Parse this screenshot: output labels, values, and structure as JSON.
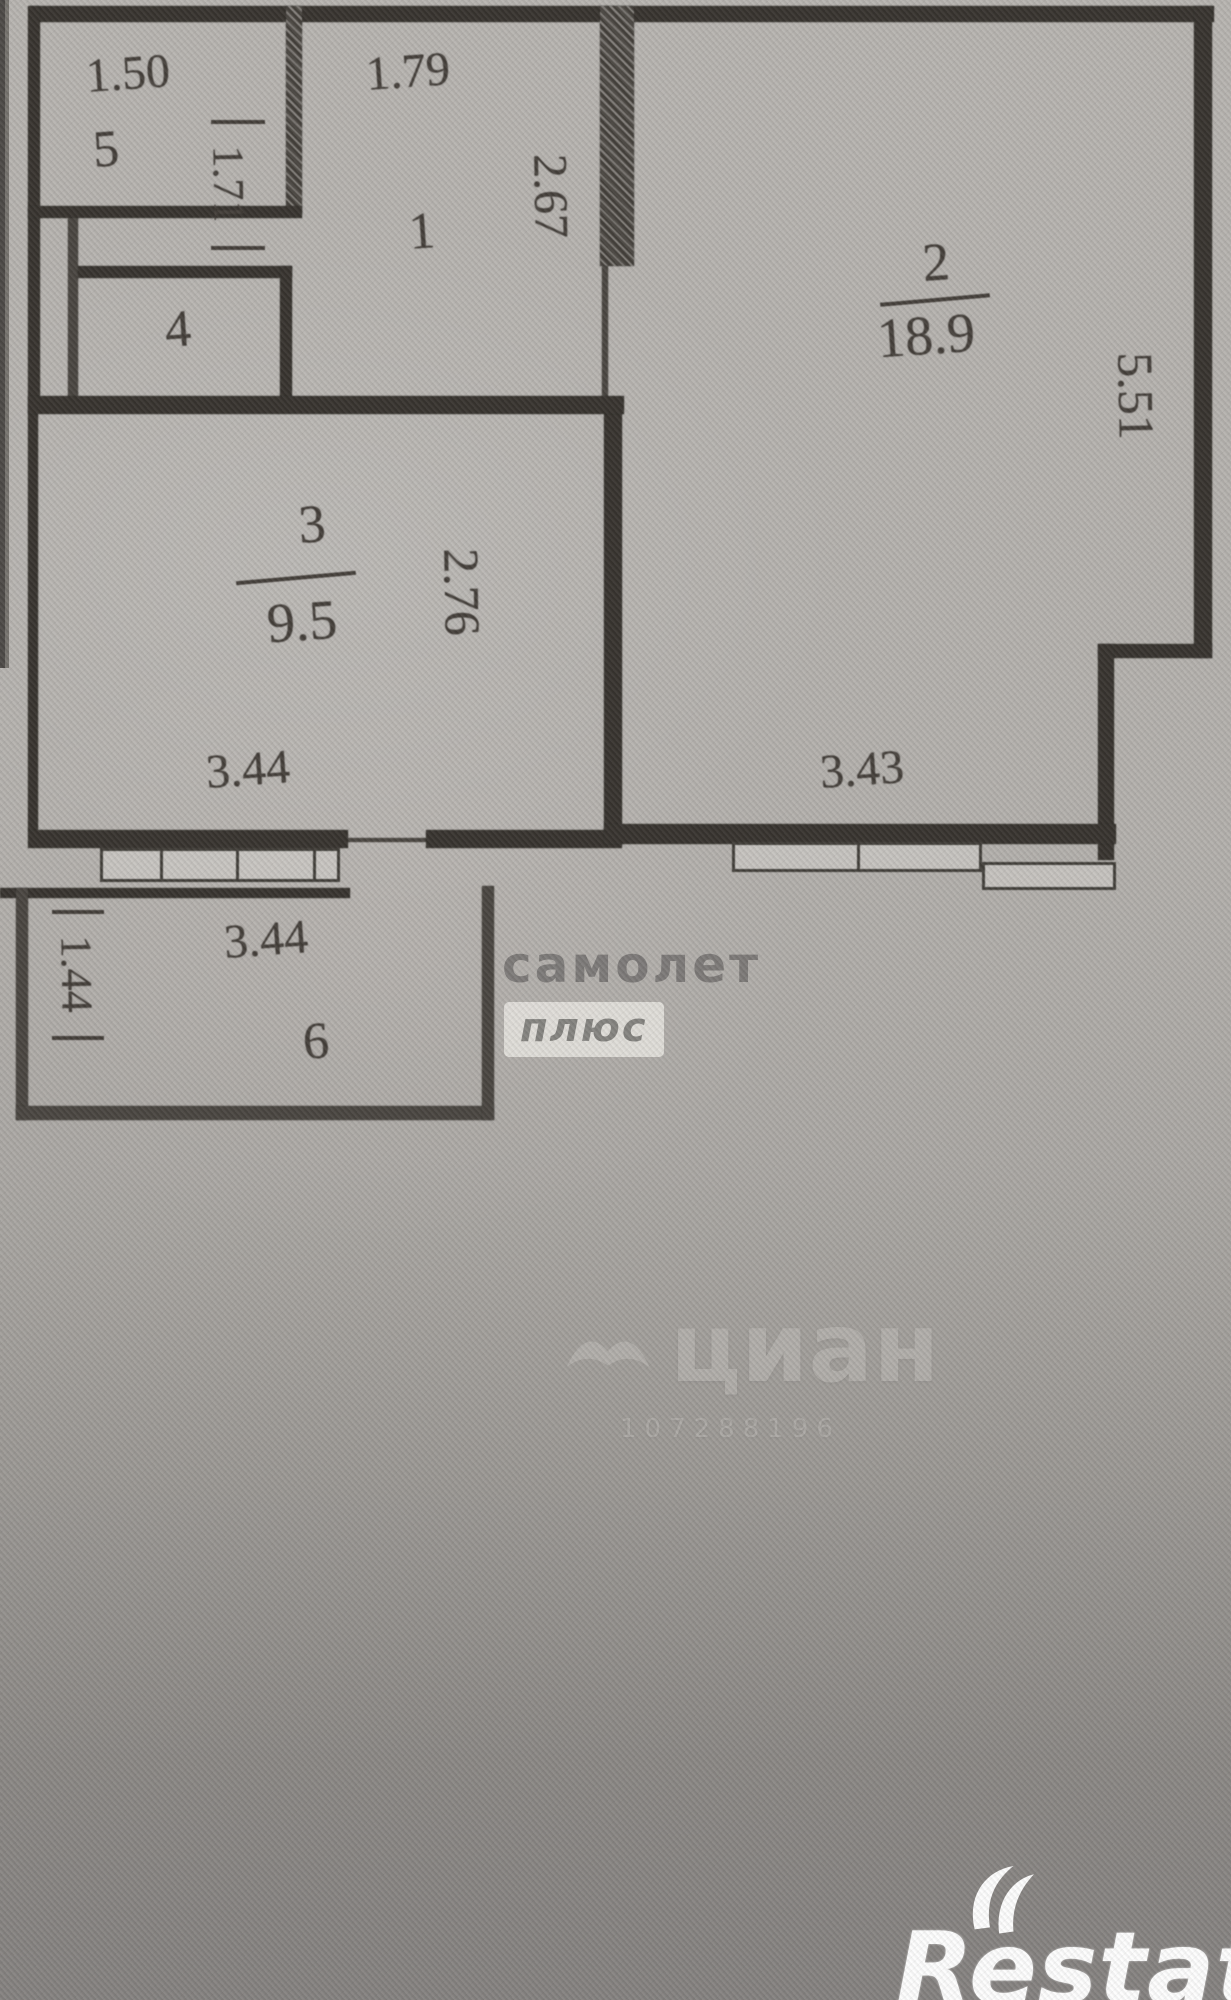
{
  "rooms": {
    "r1": {
      "number": "1",
      "width": "1.79",
      "height": "2.67"
    },
    "r2": {
      "number": "2",
      "area": "18.9",
      "width": "3.43",
      "height": "5.51"
    },
    "r3": {
      "number": "3",
      "area": "9.5",
      "width": "3.44",
      "height": "2.76"
    },
    "r4": {
      "number": "4"
    },
    "r5": {
      "number": "5",
      "width": "1.50",
      "height": "1.71"
    },
    "r6": {
      "number": "6",
      "width": "3.44",
      "height": "1.44"
    }
  },
  "watermarks": {
    "samolet_line1": "самолет",
    "samolet_line2": "плюс",
    "cian_text": "циан",
    "cian_id": "107288196",
    "restate_text": "Restate"
  },
  "colors": {
    "ink": "#38342f",
    "paper": "#b5b2ae",
    "logo_white": "#fdfdfd"
  }
}
